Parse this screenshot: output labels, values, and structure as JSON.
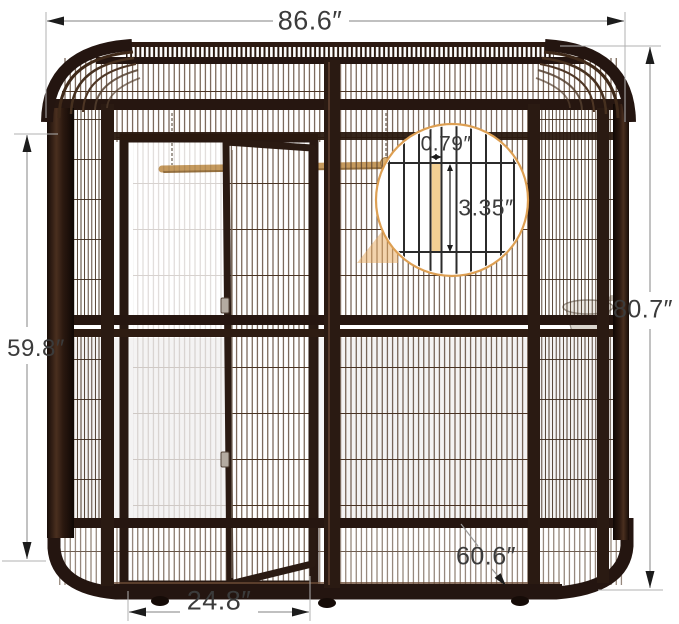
{
  "product_figure": {
    "subject": "walk-in-bird-aviary-cage-dimension-diagram",
    "annotations": {
      "top_width": "86.6″",
      "right_height": "80.7″",
      "left_height": "59.8″",
      "door_width": "24.8″",
      "depth": "60.6″",
      "mesh_gap": "0.79″",
      "mesh_cell_height": "3.35″"
    },
    "colors": {
      "frame_brown": "#261610",
      "frame_highlight": "#5d3f2c",
      "mesh_wire": "#543d2b",
      "accent_orange": "#dd9f52",
      "highlight_cell_tan": "#f3d093",
      "perch_wood": "#c59a5e",
      "dimension_line_gray": "#9a9a9a",
      "arrow_black": "#1c1c1c",
      "label_text": "#3b3b3b"
    }
  }
}
